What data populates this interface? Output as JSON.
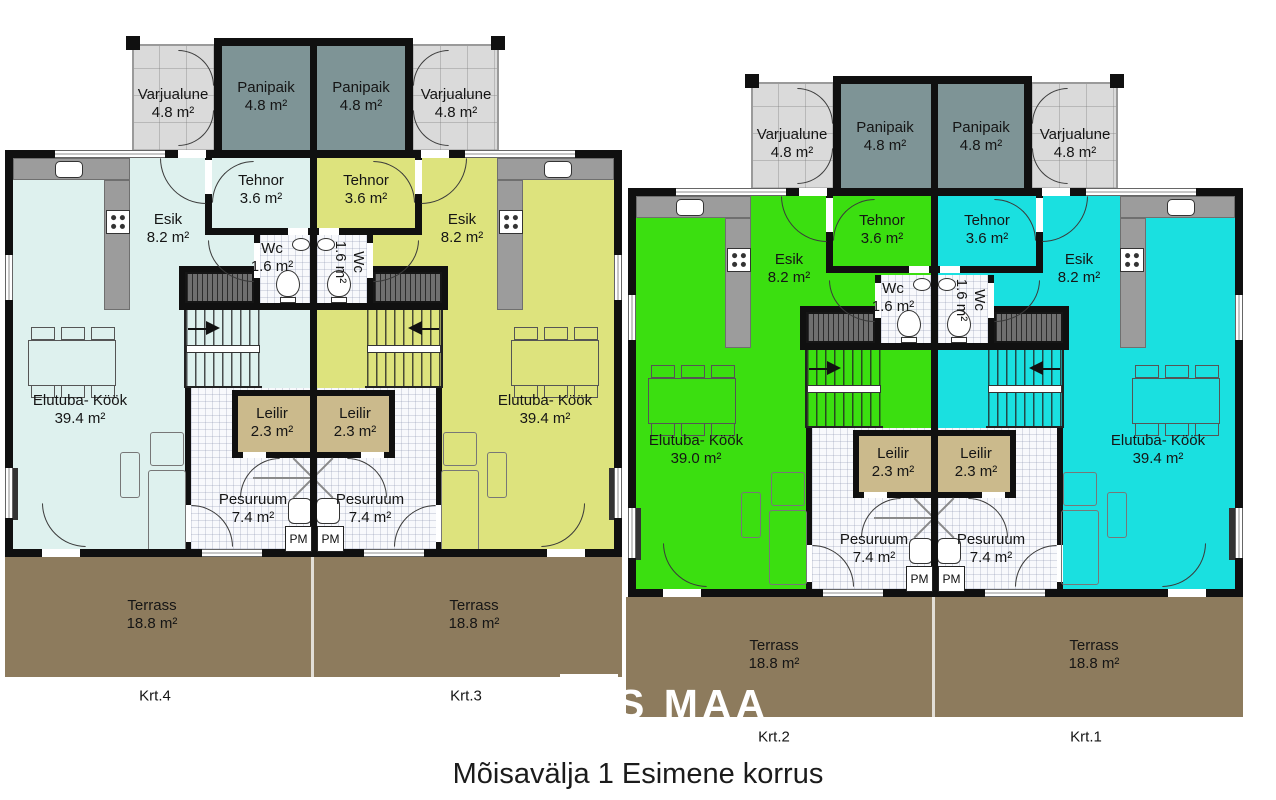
{
  "title": "Mõisavälja 1 Esimene korrus",
  "watermark": "S MAA",
  "labels": {
    "varjualune": "Varjualune",
    "varjualune_area": "4.8 m²",
    "panipaik": "Panipaik",
    "panipaik_area": "4.8 m²",
    "tehnor": "Tehnor",
    "tehnor_area": "3.6 m²",
    "esik": "Esik",
    "esik_area": "8.2 m²",
    "wc": "Wc",
    "wc_area": "1.6 m²",
    "elutuba": "Elutuba- Köök",
    "leilir": "Leilir",
    "leilir_area": "2.3 m²",
    "pesuruum": "Pesuruum",
    "pesuruum_area": "7.4 m²",
    "terrass": "Terrass",
    "terrass_area": "18.8 m²",
    "pm": "PM"
  },
  "units": {
    "krt1": {
      "label": "Krt.1",
      "elutuba_area": "39.4 m²",
      "color": "#1ae0e0"
    },
    "krt2": {
      "label": "Krt.2",
      "elutuba_area": "39.0 m²",
      "color": "#3bdf10"
    },
    "krt3": {
      "label": "Krt.3",
      "elutuba_area": "39.4 m²",
      "color": "#dde37d"
    },
    "krt4": {
      "label": "Krt.4",
      "elutuba_area": "39.4 m²",
      "color": "#def1ee"
    }
  },
  "colors": {
    "terrace": "#8d7b5d",
    "panipaik": "#7e9496",
    "leilir": "#cbba8c",
    "varjualune": "#dadada",
    "wall": "#101010"
  }
}
